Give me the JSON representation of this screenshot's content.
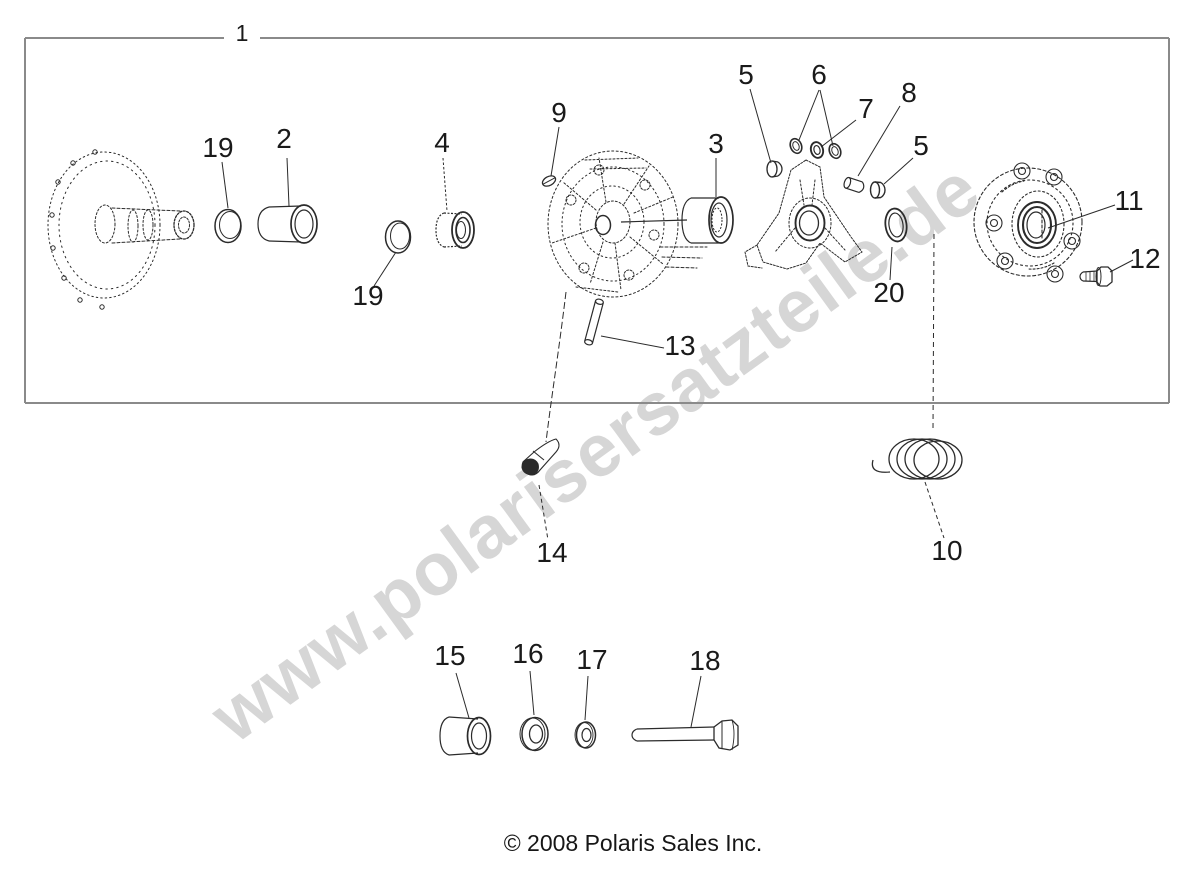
{
  "watermark": {
    "text": "www.polarisersatzteile.de",
    "color": "#d6d6d6"
  },
  "footer": {
    "copyright": "© 2008 Polaris Sales Inc."
  },
  "colors": {
    "line": "#2b2b2b",
    "border": "#8a8a8a",
    "label": "#1a1a1a",
    "background": "#ffffff"
  },
  "callouts": [
    {
      "id": "callout-1",
      "text": "1"
    },
    {
      "id": "callout-19-left",
      "text": "19"
    },
    {
      "id": "callout-2",
      "text": "2"
    },
    {
      "id": "callout-4",
      "text": "4"
    },
    {
      "id": "callout-19-right",
      "text": "19"
    },
    {
      "id": "callout-9",
      "text": "9"
    },
    {
      "id": "callout-3",
      "text": "3"
    },
    {
      "id": "callout-13",
      "text": "13"
    },
    {
      "id": "callout-5-upper",
      "text": "5"
    },
    {
      "id": "callout-6",
      "text": "6"
    },
    {
      "id": "callout-7",
      "text": "7"
    },
    {
      "id": "callout-8",
      "text": "8"
    },
    {
      "id": "callout-5-right",
      "text": "5"
    },
    {
      "id": "callout-20",
      "text": "20"
    },
    {
      "id": "callout-11",
      "text": "11"
    },
    {
      "id": "callout-12",
      "text": "12"
    },
    {
      "id": "callout-10",
      "text": "10"
    },
    {
      "id": "callout-14",
      "text": "14"
    },
    {
      "id": "callout-15",
      "text": "15"
    },
    {
      "id": "callout-16",
      "text": "16"
    },
    {
      "id": "callout-17",
      "text": "17"
    },
    {
      "id": "callout-18",
      "text": "18"
    }
  ]
}
